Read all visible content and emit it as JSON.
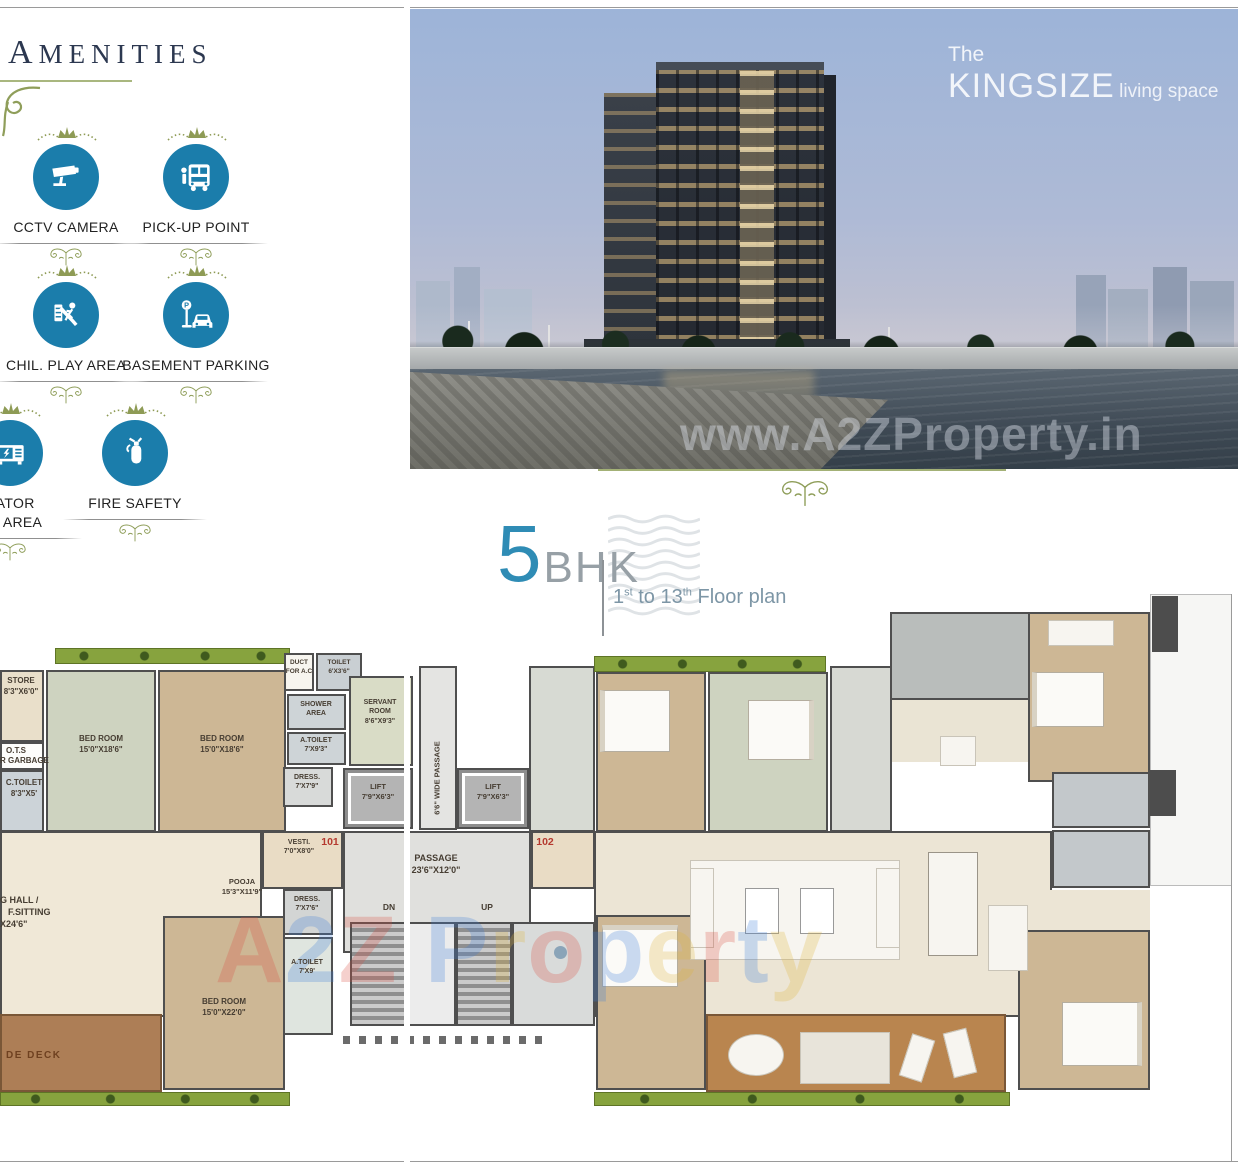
{
  "amenities": {
    "title": "AMENITIES",
    "items": [
      {
        "label": "CCTV CAMERA"
      },
      {
        "label": "PICK-UP POINT"
      },
      {
        "label": "CHIL. PLAY AREA"
      },
      {
        "label": "BASEMENT PARKING"
      },
      {
        "label": "RATOR",
        "label2": "ON AREA"
      },
      {
        "label": "FIRE SAFETY"
      }
    ]
  },
  "hero": {
    "the": "The",
    "brand": "KINGSIZE",
    "rest": "living space",
    "watermark": "www.A2ZProperty.in"
  },
  "plan_title": {
    "num": "5",
    "bhk": "BHK",
    "f1": "1",
    "s1": "st",
    "f2": " to 13",
    "s2": "th",
    "f3": " Floor plan"
  },
  "plan": {
    "watermark": "A2Z Property",
    "watermark_colors": [
      "#d94f43",
      "#3f7fd9",
      "#d94f43",
      "",
      "#3f7fd9",
      "#e0b53c",
      "#d94f43",
      "#3f7fd9",
      "#e0b53c",
      "#d94f43",
      "#3f7fd9",
      "#e0b53c"
    ],
    "units": {
      "u101": "101",
      "u102": "102"
    },
    "labels": {
      "store": {
        "l1": "STORE",
        "l2": "8'3\"X6'0\""
      },
      "ots": {
        "l1": "O.T.S"
      },
      "garbage": {
        "l1": "R GARBAGE"
      },
      "c_toilet": {
        "l1": "C.TOILET",
        "l2": "8'3\"X5'"
      },
      "bed1": {
        "l1": "BED ROOM",
        "l2": "15'0\"X18'6\""
      },
      "bed2": {
        "l1": "BED ROOM",
        "l2": "15'0\"X18'6\""
      },
      "duct": {
        "l1": "DUCT",
        "l2": "FOR A.C"
      },
      "toilet": {
        "l1": "TOILET",
        "l2": "6'X3'6\""
      },
      "shower": {
        "l1": "SHOWER",
        "l2": "AREA"
      },
      "a_toilet1": {
        "l1": "A.TOILET",
        "l2": "7'X9'3\""
      },
      "dress1": {
        "l1": "DRESS.",
        "l2": "7'X7'9\""
      },
      "servant": {
        "l1": "SERVANT",
        "l2": "ROOM",
        "l3": "8'6\"X9'3\""
      },
      "lift1": {
        "l1": "LIFT",
        "l2": "7'9\"X6'3\""
      },
      "lift2": {
        "l1": "LIFT",
        "l2": "7'9\"X6'3\""
      },
      "wide_passage": {
        "l1": "6'6\" WIDE PASSAGE"
      },
      "vesti": {
        "l1": "VESTI.",
        "l2": "7'0\"X8'0\""
      },
      "passage": {
        "l1": "PASSAGE",
        "l2": "23'6\"X12'0\""
      },
      "dn": {
        "l1": "DN"
      },
      "up": {
        "l1": "UP"
      },
      "pooja": {
        "l1": "POOJA",
        "l2": "15'3\"X11'9\""
      },
      "hall": {
        "l1": "G HALL /",
        "l2": "F.SITTING",
        "l3": "X24'6\""
      },
      "dress2": {
        "l1": "DRESS.",
        "l2": "7'X7'6\""
      },
      "a_toilet2": {
        "l1": "A.TOILET",
        "l2": "7'X9'"
      },
      "bed3": {
        "l1": "BED ROOM",
        "l2": "15'0\"X22'0\""
      },
      "deck": {
        "l1": "DE DECK"
      }
    }
  }
}
